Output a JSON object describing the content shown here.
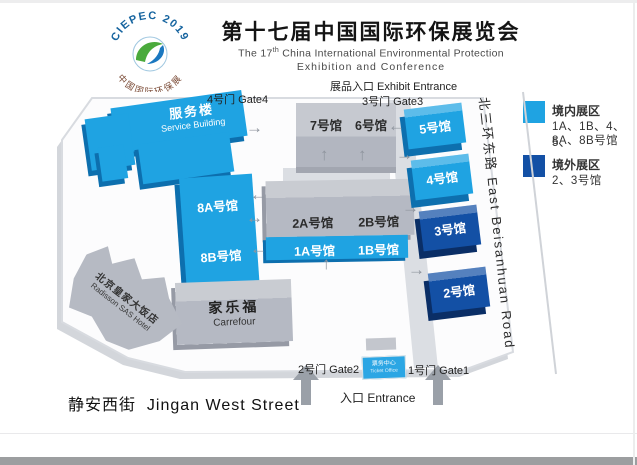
{
  "header": {
    "logo": {
      "arc_top": "CIEPEC 2019",
      "arc_bottom": "中国国际环保展"
    },
    "title_cn": "第十七届中国国际环保展览会",
    "subtitle": {
      "part1": "The 17",
      "sup": "th",
      "part2": " China International Environmental Protection",
      "line2": "Exhibition and Conference"
    }
  },
  "legend": {
    "inside": {
      "color": "#1fa3e2",
      "title": "境内展区",
      "line1": "1A、1B、4、5、",
      "line2": "8A、8B号馆"
    },
    "outside": {
      "color": "#1350a5",
      "title": "境外展区",
      "line1": "2、3号馆"
    }
  },
  "map": {
    "entrances": {
      "exhibit": "展品入口 Exhibit Entrance",
      "gate4": "4号门 Gate4",
      "gate3": "3号门 Gate3",
      "gate2": "2号门 Gate2",
      "gate1": "1号门 Gate1",
      "main": "入口 Entrance"
    },
    "halls": {
      "h7": "7号馆",
      "h6": "6号馆",
      "h5": "5号馆",
      "h4": "4号馆",
      "h3": "3号馆",
      "h2": "2号馆",
      "h8a": "8A号馆",
      "h8b": "8B号馆",
      "h2a": "2A号馆",
      "h2b": "2B号馆",
      "h1a": "1A号馆",
      "h1b": "1B号馆"
    },
    "buildings": {
      "service": {
        "cn": "服务楼",
        "en": "Service Building"
      },
      "carrefour": {
        "cn": "家乐福",
        "en": "Carrefour"
      },
      "hotel": {
        "cn": "北京皇家大饭店",
        "en": "Radisson SAS Hotel"
      },
      "ticket": {
        "cn": "票务中心",
        "en": "Ticket Office"
      }
    },
    "roads": {
      "south_cn": "静安西街",
      "south_en": "Jingan West Street",
      "east_cn": "北三环东路",
      "east_en": "East Beisanhuan Road"
    }
  },
  "icons": {
    "arrow_up": "↑",
    "arrow_left": "←",
    "arrow_right": "→",
    "arrow_left_right": "↔"
  },
  "colors": {
    "hall_light_blue": "#1fa3e2",
    "hall_dark_blue": "#1350a5",
    "building_gray": "#b5b9c3"
  }
}
